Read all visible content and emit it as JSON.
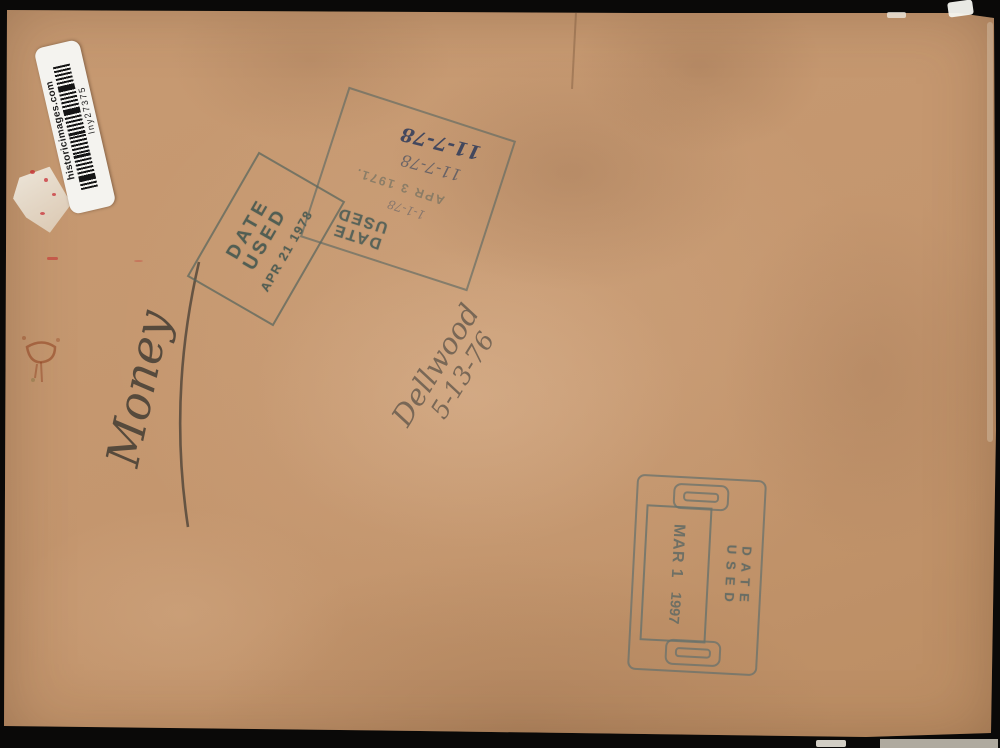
{
  "artifact": {
    "description": "back of photographic print",
    "sticker": {
      "site": "historicimages.com",
      "code": "lny27375",
      "barcode_icon": "barcode"
    },
    "stamp_date_used_1978": {
      "word1": "DATE",
      "word2": "USED",
      "date": "APR 21 1978"
    },
    "stamp_date_used_1971": {
      "word1": "DATE",
      "word2": "USED",
      "stamped_date": "APR 3 1971.",
      "handwritten_dates": [
        "1-1-78",
        "11-7-78",
        "11-7-78"
      ]
    },
    "handwriting": {
      "word": "Money",
      "name": "Dellwood",
      "date": "5-13-76"
    },
    "stamp_date_used_1997": {
      "label": "DATE USED",
      "date": "MAR 1",
      "year": "1997"
    },
    "colors": {
      "paper": "#c5976f",
      "stamp_ink": "#5c6f66",
      "pen_ink": "#3e5570",
      "pencil": "#4f4a42",
      "sticker_bg": "#f4f3ef",
      "background": "#0a0908"
    }
  }
}
